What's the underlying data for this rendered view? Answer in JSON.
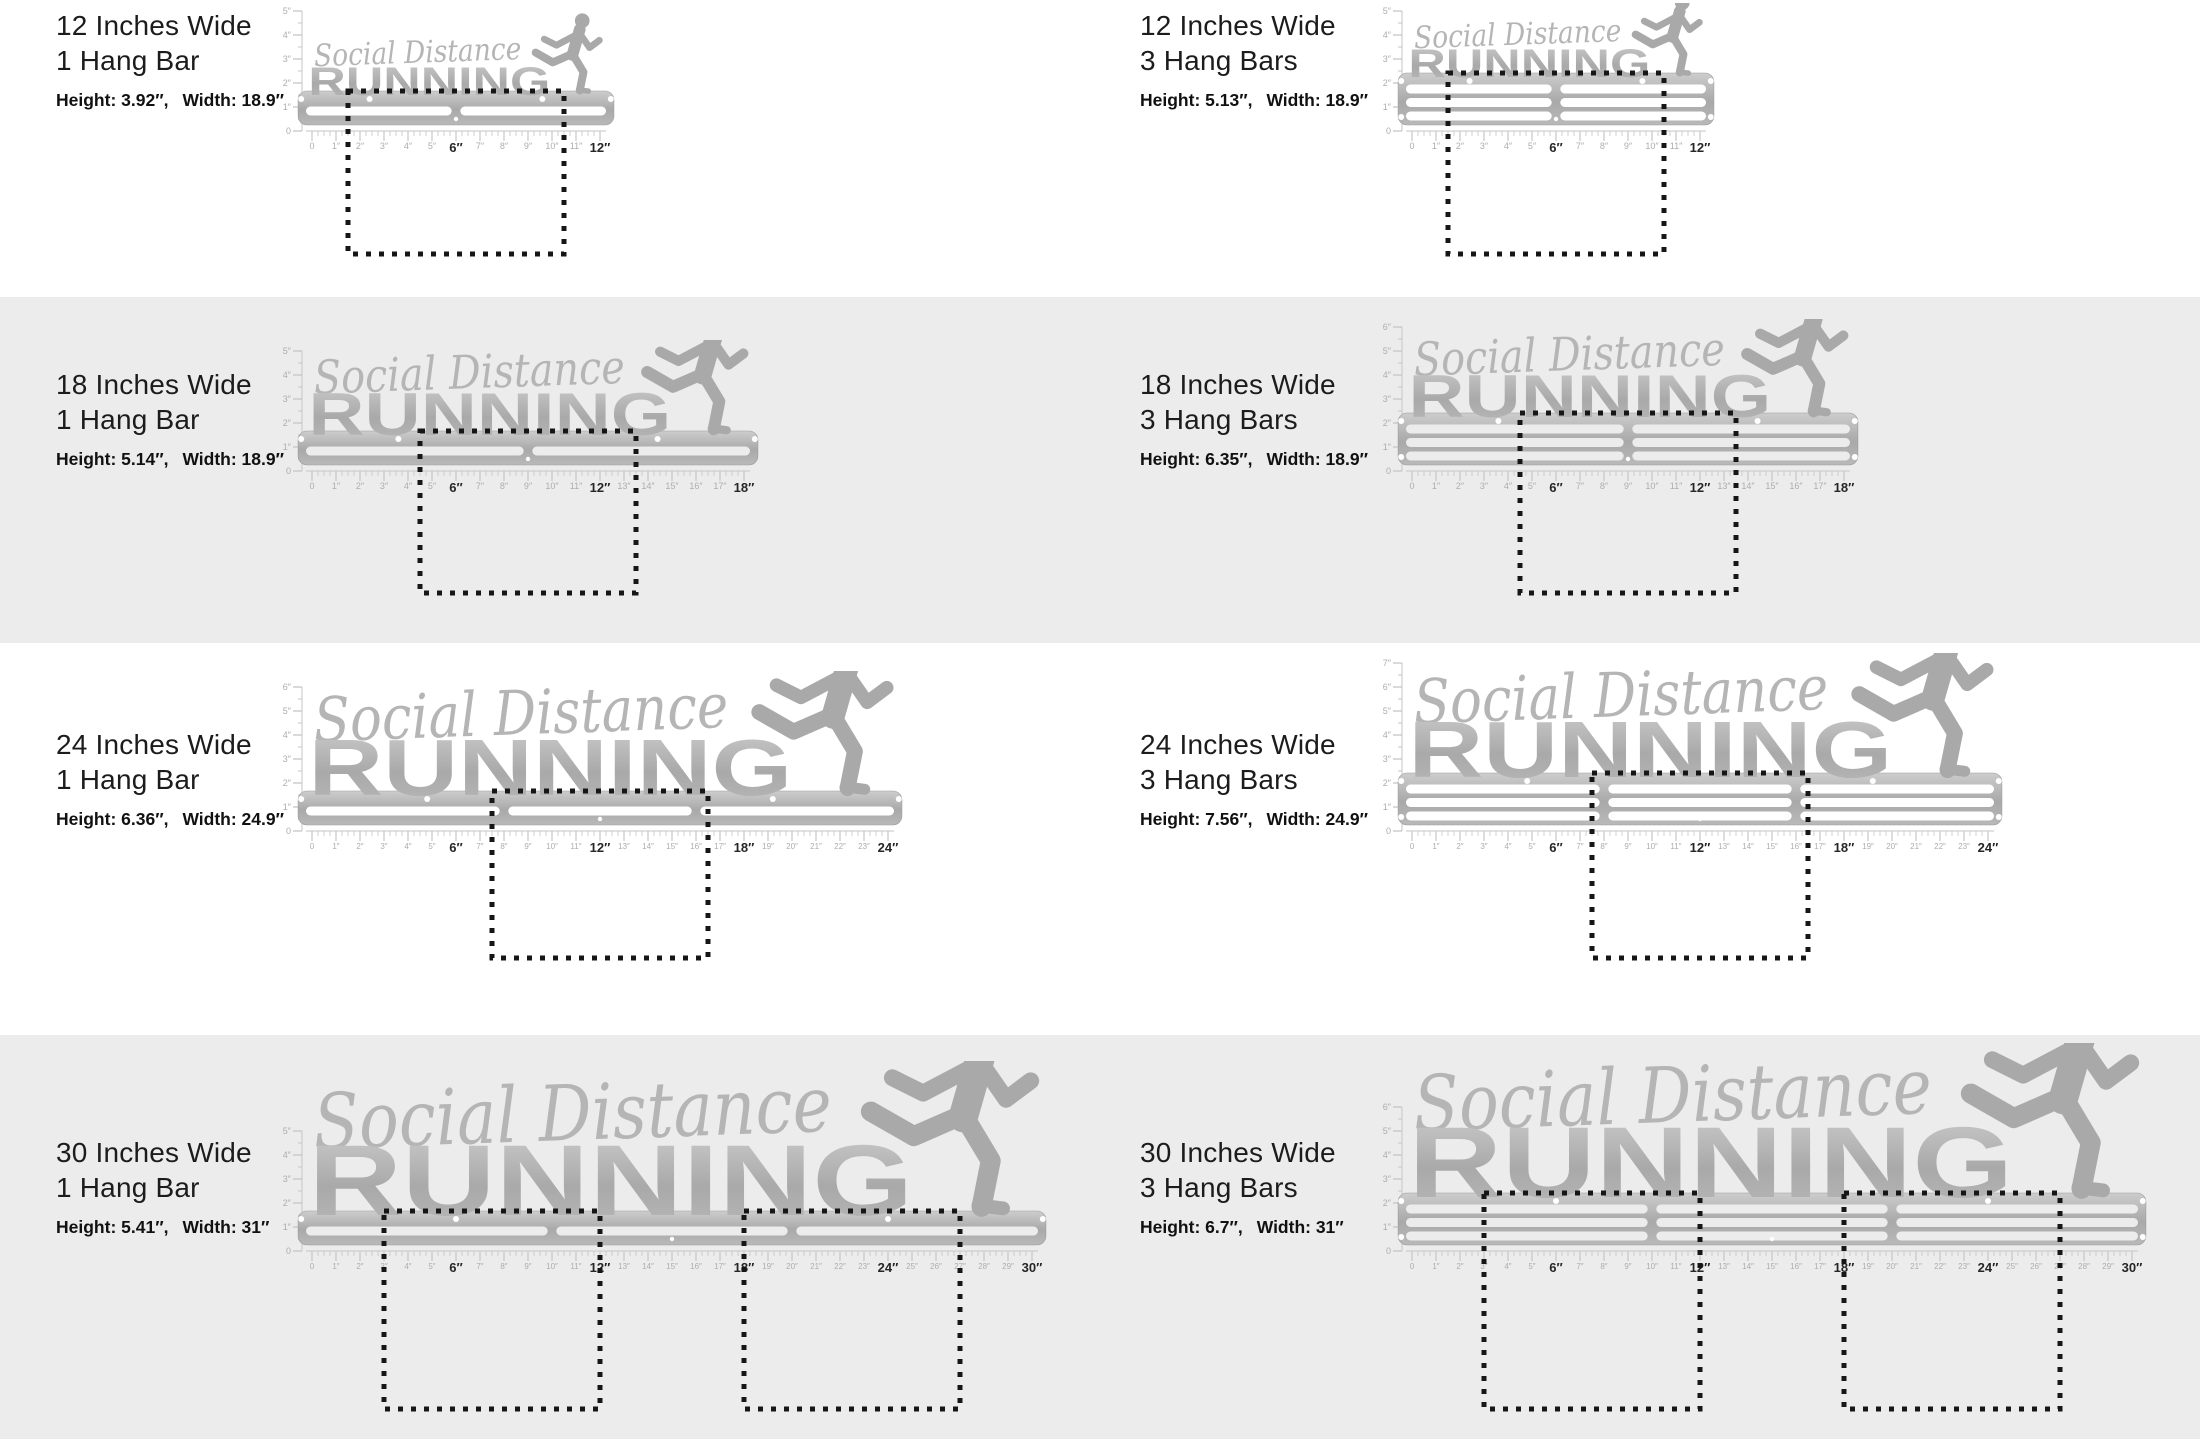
{
  "page": {
    "bg": "#ffffff",
    "band_bg": "#ececec",
    "label_color": "#1c1c1c",
    "dotted_color": "#161616",
    "steel_light": "#cdcdcd",
    "steel_mid": "#a9a9a9",
    "steel_dark": "#b9b9b9",
    "script_color": "#b5b5b5",
    "ruler_color": "#c6c6c6",
    "ruler_label_color": "#adadad",
    "ruler_label_bold_color": "#262626"
  },
  "artwork": {
    "script_text": "Social Distance",
    "block_text": "RUNNING",
    "runner_icon": "runner-silhouette"
  },
  "rows": [
    {
      "gray": false,
      "top": 0,
      "height": 297,
      "label_y": 8,
      "y0": 131,
      "depth": 131,
      "panels": [
        {
          "title1": "12 Inches Wide",
          "title2": "1 Hang Bar",
          "spec_height": "Height: 3.92″,",
          "spec_width": "Width: 18.9″",
          "inches": 12,
          "bars": 1,
          "vmax": 5,
          "bold_step": 6,
          "dotted": [
            [
              1.5,
              10.5
            ]
          ]
        },
        {
          "title1": "12 Inches Wide",
          "title2": "3 Hang Bars",
          "spec_height": "Height: 5.13″,",
          "spec_width": "Width: 18.9″",
          "inches": 12,
          "bars": 3,
          "vmax": 5,
          "bold_step": 6,
          "dotted": [
            [
              1.5,
              10.5
            ]
          ]
        }
      ]
    },
    {
      "gray": true,
      "top": 297,
      "height": 346,
      "label_y": 70,
      "y0": 174,
      "depth": 130,
      "panels": [
        {
          "title1": "18 Inches Wide",
          "title2": "1 Hang Bar",
          "spec_height": "Height: 5.14″,",
          "spec_width": "Width: 18.9″",
          "inches": 18,
          "bars": 1,
          "vmax": 5,
          "bold_step": 6,
          "dotted": [
            [
              4.5,
              13.5
            ]
          ]
        },
        {
          "title1": "18 Inches Wide",
          "title2": "3 Hang Bars",
          "spec_height": "Height: 6.35″,",
          "spec_width": "Width: 18.9″",
          "inches": 18,
          "bars": 3,
          "vmax": 6,
          "bold_step": 6,
          "dotted": [
            [
              4.5,
              13.5
            ]
          ]
        }
      ]
    },
    {
      "gray": false,
      "top": 643,
      "height": 392,
      "label_y": 84,
      "y0": 188,
      "depth": 135,
      "panels": [
        {
          "title1": "24 Inches Wide",
          "title2": "1 Hang Bar",
          "spec_height": "Height: 6.36″,",
          "spec_width": "Width: 24.9″",
          "inches": 24,
          "bars": 1,
          "vmax": 6,
          "bold_step": 6,
          "dotted": [
            [
              7.5,
              16.5
            ]
          ]
        },
        {
          "title1": "24 Inches Wide",
          "title2": "3 Hang Bars",
          "spec_height": "Height: 7.56″,",
          "spec_width": "Width: 24.9″",
          "inches": 24,
          "bars": 3,
          "vmax": 7,
          "bold_step": 6,
          "dotted": [
            [
              7.5,
              16.5
            ]
          ]
        }
      ]
    },
    {
      "gray": true,
      "top": 1035,
      "height": 404,
      "label_y": 100,
      "y0": 216,
      "depth": 166,
      "panels": [
        {
          "title1": "30 Inches Wide",
          "title2": "1 Hang Bar",
          "spec_height": "Height: 5.41″,",
          "spec_width": "Width: 31″",
          "inches": 30,
          "bars": 1,
          "vmax": 5,
          "bold_step": 6,
          "dotted": [
            [
              3,
              12
            ],
            [
              18,
              27
            ]
          ]
        },
        {
          "title1": "30 Inches Wide",
          "title2": "3 Hang Bars",
          "spec_height": "Height: 6.7″,",
          "spec_width": "Width: 31″",
          "inches": 30,
          "bars": 3,
          "vmax": 6,
          "bold_step": 6,
          "dotted": [
            [
              3,
              12
            ],
            [
              18,
              27
            ]
          ]
        }
      ]
    }
  ],
  "layout_labels": {
    "left_label_x": 56,
    "right_label_x": 1140,
    "left_svg_x": 272,
    "right_svg_x": 1372
  }
}
